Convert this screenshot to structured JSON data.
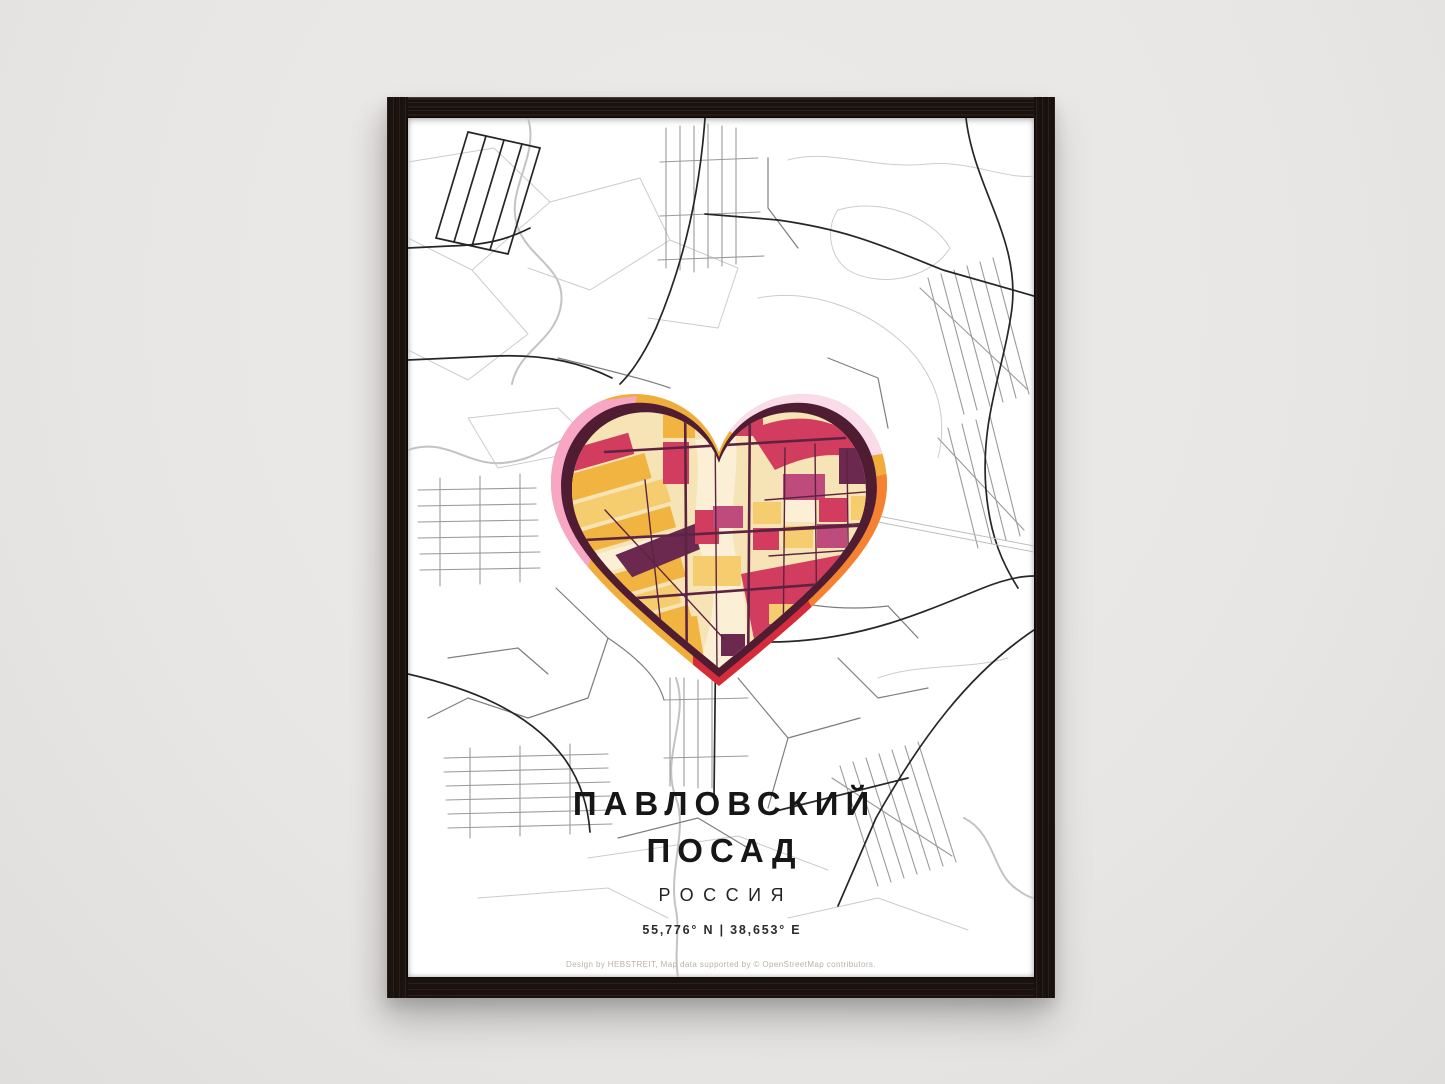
{
  "poster": {
    "title_line1": "ПАВЛОВСКИЙ",
    "title_line2": "ПОСАД",
    "subtitle": "РОССИЯ",
    "coordinates": "55,776° N | 38,653° E",
    "credit": "Design by HEBSTREIT, Map data supported by © OpenStreetMap contributors."
  },
  "colors": {
    "wall": "#eceae8",
    "frame_wood": "#1f1510",
    "poster_bg": "#ffffff",
    "map_line_light": "#cccccc",
    "map_line_gray": "#9a9a9a",
    "map_line_dark": "#262626",
    "heart_outline": "#4f1c31",
    "heart_street": "#5d2340",
    "ring_gold": "#efae3c",
    "ring_pink": "#f7a6c4",
    "ring_light_pink": "#fadbe9",
    "ring_orange": "#f58233",
    "ring_red": "#d52c3c",
    "block_gold": "#f1b440",
    "block_yellow": "#f6cd6e",
    "block_cream": "#f6e4b6",
    "block_cream_light": "#fbf0d6",
    "block_crimson": "#d23c5e",
    "block_magenta": "#bf4a7c",
    "block_purple": "#6b2950",
    "title_color": "#161616",
    "credit_color": "#b9b1a6"
  }
}
